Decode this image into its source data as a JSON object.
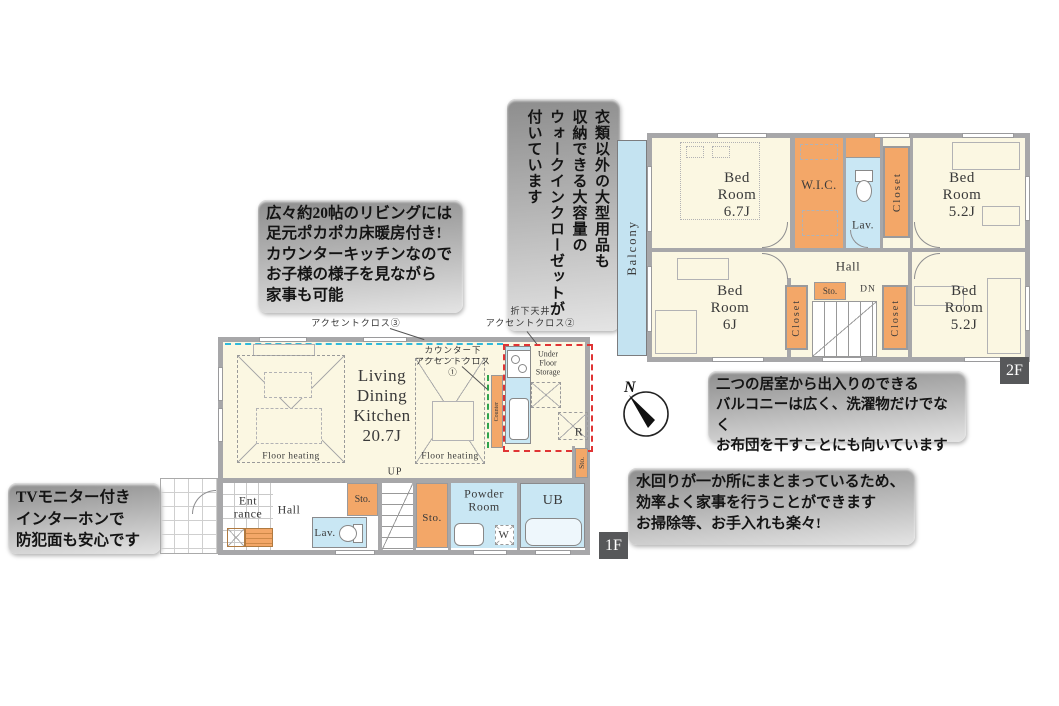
{
  "callouts": {
    "wic_note": "衣類以外の大型用品も\n収納できる大容量の\nウォークインクローゼットが\n付いています",
    "living_note": "広々約20帖のリビングには\n足元ポカポカ床暖房付き!\nカウンターキッチンなので\nお子様の様子を見ながら\n家事も可能",
    "tv_note": "TVモニター付き\nインターホンで\n防犯面も安心です",
    "balcony_note": "二つの居室から出入りのできる\nバルコニーは広く、洗濯物だけでなく\nお布団を干すことにも向いています",
    "utility_note": "水回りが一か所にまとまっているため、\n効率よく家事を行うことができます\nお掃除等、お手入れも楽々!"
  },
  "floor2": {
    "badge": "2F",
    "balcony": "Balcony",
    "bedroom_nw": "Bed\nRoom\n6.7J",
    "wic": "W.I.C.",
    "lav": "Lav.",
    "closet_top": "Closet",
    "bedroom_ne": "Bed\nRoom\n5.2J",
    "bedroom_sw": "Bed\nRoom\n6J",
    "storage": "Sto.",
    "down": "DN",
    "hall": "Hall",
    "closet_sw": "Closet",
    "closet_se": "Closet",
    "bedroom_se": "Bed\nRoom\n5.2J"
  },
  "floor1": {
    "badge": "1F",
    "ldk": "Living\nDining\nKitchen\n20.7J",
    "floor_heating_left": "Floor heating",
    "floor_heating_right": "Floor heating",
    "accent_cloth_3": "アクセントクロス③",
    "accent_cloth_2": "折下天井\nアクセントクロス②",
    "accent_cloth_1": "カウンター下\nアクセントクロス①",
    "counter": "Counter",
    "under_floor_storage": "Under\nFloor\nStorage",
    "refrigerator": "R",
    "storage_kitchen": "Sto.",
    "up": "UP",
    "entrance": "Ent\nrance",
    "hall": "Hall",
    "storage_hall": "Sto.",
    "lav": "Lav.",
    "storage_center": "Sto.",
    "powder_room": "Powder\nRoom",
    "washer": "W",
    "unit_bath": "UB"
  },
  "compass": {
    "north": "N"
  },
  "colors": {
    "room_fill": "#fbf7e2",
    "storage_fill": "#f3a768",
    "water_fill": "#c9e7f4",
    "balcony_fill": "#c4e3f1",
    "wall": "#a7a7a9",
    "accent_cyan": "#2fb9da",
    "accent_red": "#e03434",
    "accent_green": "#2fa34c",
    "badge_bg": "#57585a"
  }
}
